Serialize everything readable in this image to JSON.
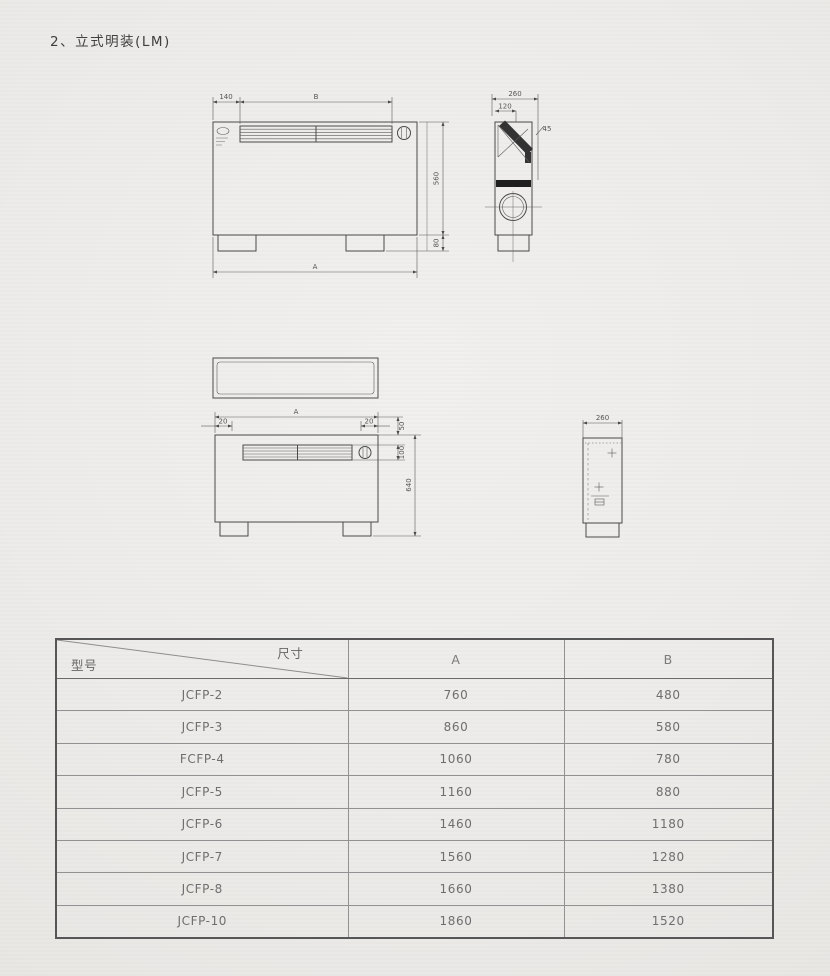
{
  "page": {
    "title": "2、立式明装(LM)"
  },
  "colors": {
    "paper": "#edecea",
    "line": "#4a4a4a",
    "text": "#5f5f5f"
  },
  "drawings": {
    "front_view_1": {
      "dim_left_top": "140",
      "dim_top_width": "B",
      "dim_body_height": "560",
      "dim_foot_height": "80",
      "dim_total_width": "A"
    },
    "side_view_1": {
      "dim_depth": "260",
      "dim_inset": "120",
      "dim_angle": "45"
    },
    "front_view_2": {
      "dim_total_width": "A",
      "dim_margin_left": "20",
      "dim_margin_right": "20",
      "dim_top_gap": "50",
      "dim_grille_height": "100",
      "dim_total_height": "640"
    },
    "side_view_2": {
      "dim_depth": "260"
    }
  },
  "table": {
    "header": {
      "model_label": "型号",
      "size_label": "尺寸",
      "col_a": "A",
      "col_b": "B"
    },
    "rows": [
      {
        "model": "JCFP-2",
        "a": "760",
        "b": "480"
      },
      {
        "model": "JCFP-3",
        "a": "860",
        "b": "580"
      },
      {
        "model": "FCFP-4",
        "a": "1060",
        "b": "780"
      },
      {
        "model": "JCFP-5",
        "a": "1160",
        "b": "880"
      },
      {
        "model": "JCFP-6",
        "a": "1460",
        "b": "1180"
      },
      {
        "model": "JCFP-7",
        "a": "1560",
        "b": "1280"
      },
      {
        "model": "JCFP-8",
        "a": "1660",
        "b": "1380"
      },
      {
        "model": "JCFP-10",
        "a": "1860",
        "b": "1520"
      }
    ]
  }
}
